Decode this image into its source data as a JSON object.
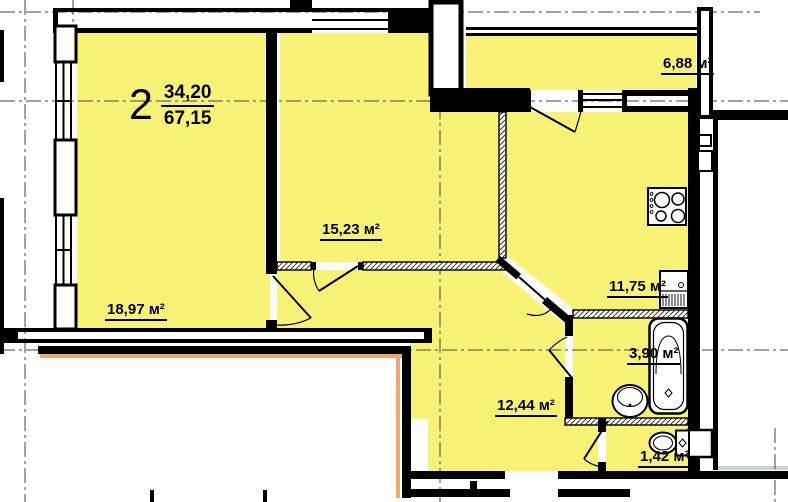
{
  "apartment": {
    "number": "2",
    "living_area": "34,20",
    "total_area": "67,15"
  },
  "rooms": {
    "living": {
      "area_label": "18,97 м²"
    },
    "bedroom": {
      "area_label": "15,23 м²"
    },
    "kitchen": {
      "area_label": "11,75 м²"
    },
    "balcony": {
      "area_label": "6,88 м²"
    },
    "bathroom": {
      "area_label": "3,90 м²"
    },
    "hallway": {
      "area_label": "12,44 м²"
    },
    "wc": {
      "area_label": "1,42 м²"
    }
  },
  "colors": {
    "room_fill": "#f8f377",
    "wall": "#000000",
    "neighbor_outline": "#edaa6f",
    "adjacent_section_outline": "#c6d9c6",
    "axis_line": "#444444"
  },
  "icons": [
    "stove-icon",
    "kitchen-sink-icon",
    "bathtub-icon",
    "washbasin-icon",
    "toilet-icon",
    "vent-shaft-icon",
    "window-glyph",
    "door-swing-glyph"
  ]
}
